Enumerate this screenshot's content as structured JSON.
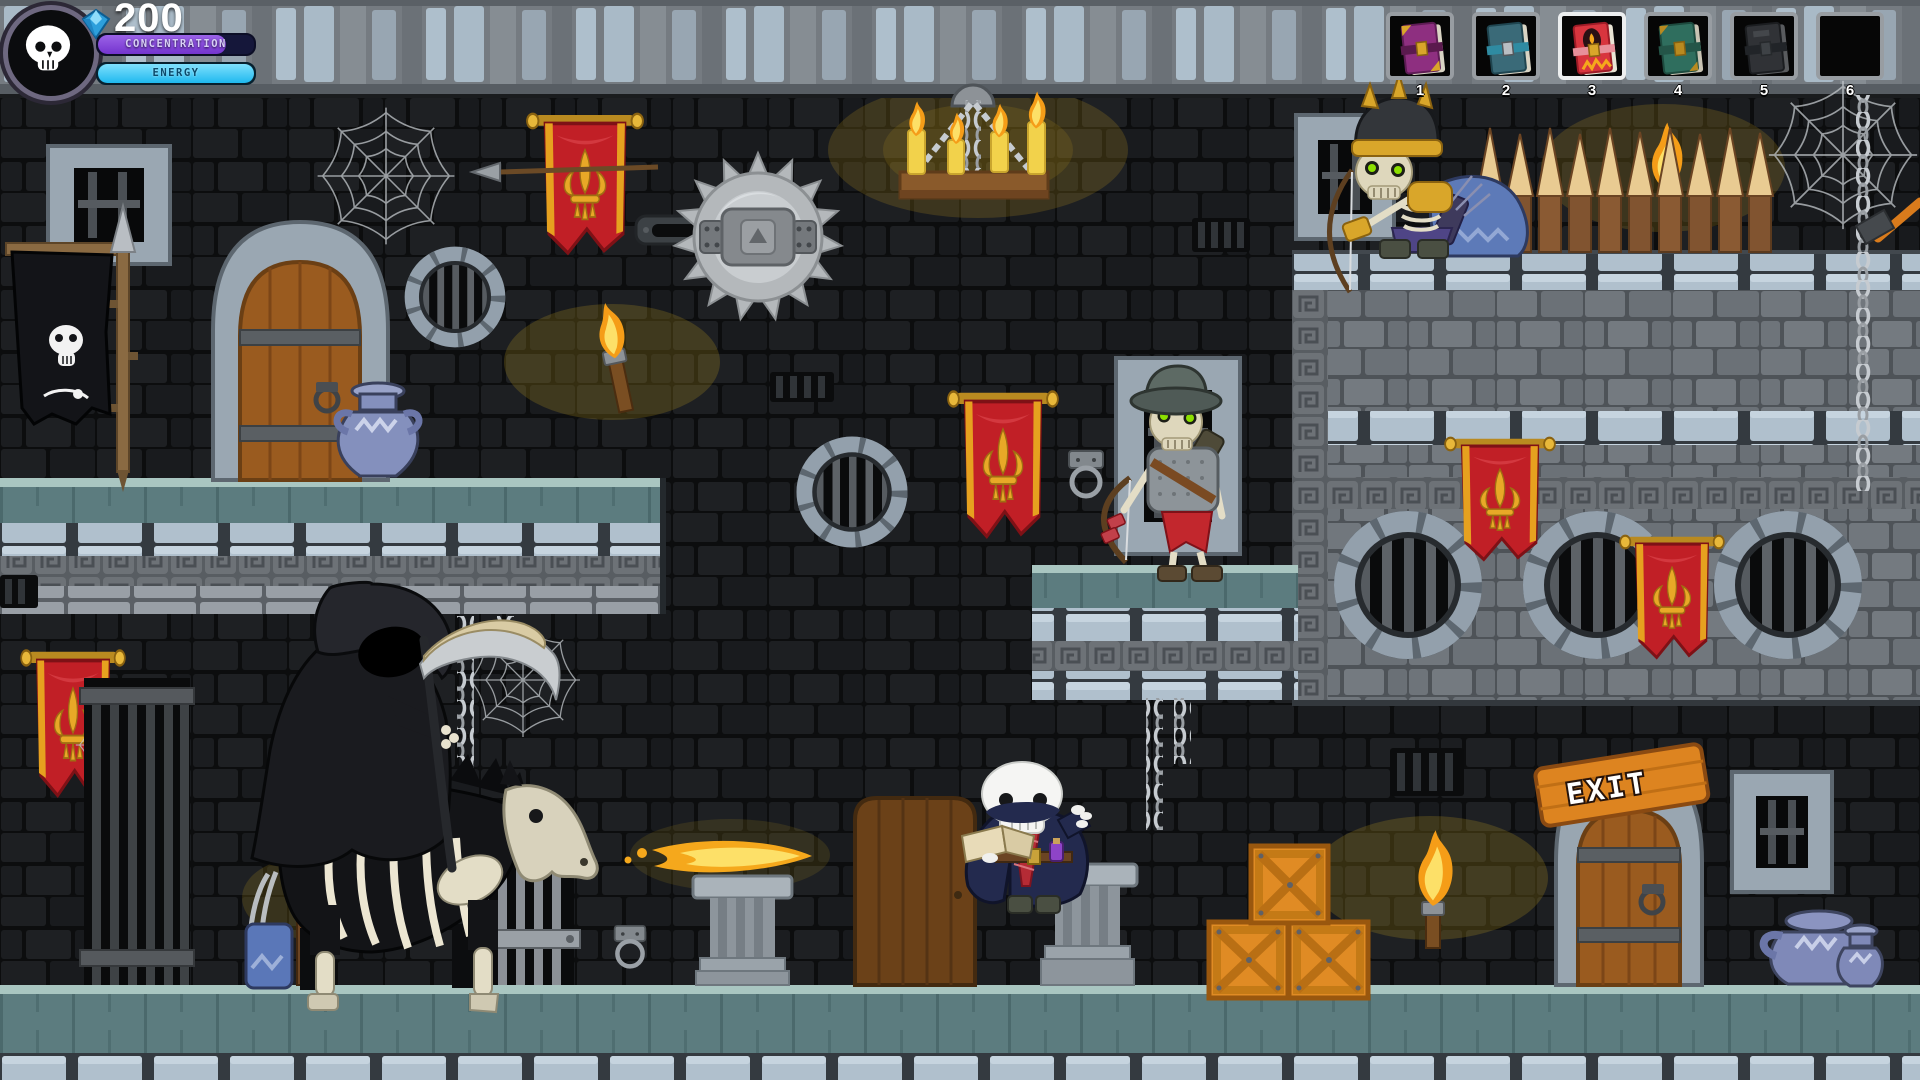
{
  "hud": {
    "avatar": {
      "icon": "skull-icon"
    },
    "currency": {
      "icon": "gem-icon",
      "value": "200"
    },
    "bars": {
      "concentration": {
        "label": "CONCENTRATION",
        "fill_percent": "82%"
      },
      "energy": {
        "label": "ENERGY",
        "fill_percent": "100%"
      }
    },
    "inventory": {
      "selected_slot": "3",
      "slots": [
        {
          "number": "1",
          "item": "purple-spellbook"
        },
        {
          "number": "2",
          "item": "teal-spellbook"
        },
        {
          "number": "3",
          "item": "red-flame-spellbook"
        },
        {
          "number": "4",
          "item": "green-spellbook"
        },
        {
          "number": "5",
          "item": "dark-spellbook"
        },
        {
          "number": "6",
          "item": ""
        }
      ]
    }
  },
  "world": {
    "exit_sign": {
      "label": "EXIT"
    },
    "objects": [
      "player-skeleton-mage",
      "grim-reaper-on-skeleton-horse",
      "skeleton-archer-window",
      "skeleton-archer-gold",
      "saw-blade-trap",
      "candle-chandelier",
      "wooden-spikes",
      "red-fleur-banners",
      "skull-flag",
      "crates",
      "torches",
      "barred-windows",
      "exit-door"
    ]
  },
  "colors": {
    "banner_red": "#c11f26",
    "banner_gold": "#e8a827",
    "concentration_fill": "#7e3fd6",
    "energy_fill": "#2ac4f2",
    "crate_orange": "#e08b24",
    "glow_yellow": "#c8a21e",
    "stone_light": "#b0c0cd",
    "stone_mid": "#6e747a"
  }
}
